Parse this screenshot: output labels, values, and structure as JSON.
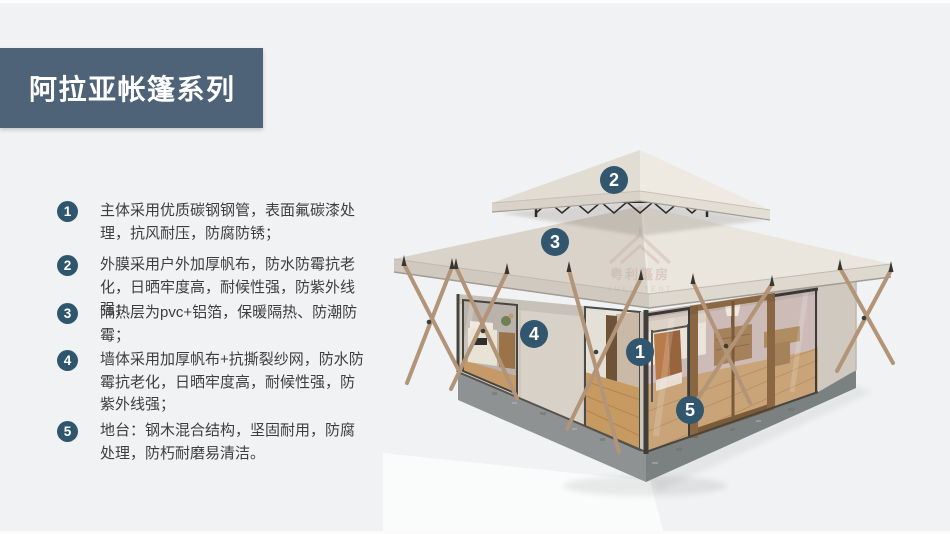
{
  "page": {
    "background_color": "#f1f2f3",
    "banner_color": "#4e6377",
    "badge_color": "#30566e",
    "roof_color": "#eae6dd",
    "canvas_wall_color": "#d7d1c7",
    "platform_color": "#8f9293",
    "wood_pole_color": "#b29478",
    "floor_wood_color": "#c69c68"
  },
  "header": {
    "title": "阿拉亚帐篷系列"
  },
  "features": [
    {
      "number": "1",
      "text": "主体采用优质碳钢钢管，表面氟碳漆处理，抗风耐压，防腐防锈；"
    },
    {
      "number": "2",
      "text": "外膜采用户外加厚帆布，防水防霉抗老化，日晒牢度高，耐候性强，防紫外线强；"
    },
    {
      "number": "3",
      "text": "隔热层为pvc+铝箔，保暖隔热、防潮防霉；"
    },
    {
      "number": "4",
      "text": "墙体采用加厚帆布+抗撕裂纱网，防水防霉抗老化，日晒牢度高，耐候性强，防紫外线强；"
    },
    {
      "number": "5",
      "text": "地台：钢木混合结构，坚固耐用，防腐处理，防朽耐磨易清洁。"
    }
  ],
  "tent": {
    "markers": {
      "m1": "1",
      "m2": "2",
      "m3": "3",
      "m4": "4",
      "m5": "5"
    },
    "watermark": {
      "cn": "粤利篷房",
      "en": "YUELI TENT"
    }
  }
}
